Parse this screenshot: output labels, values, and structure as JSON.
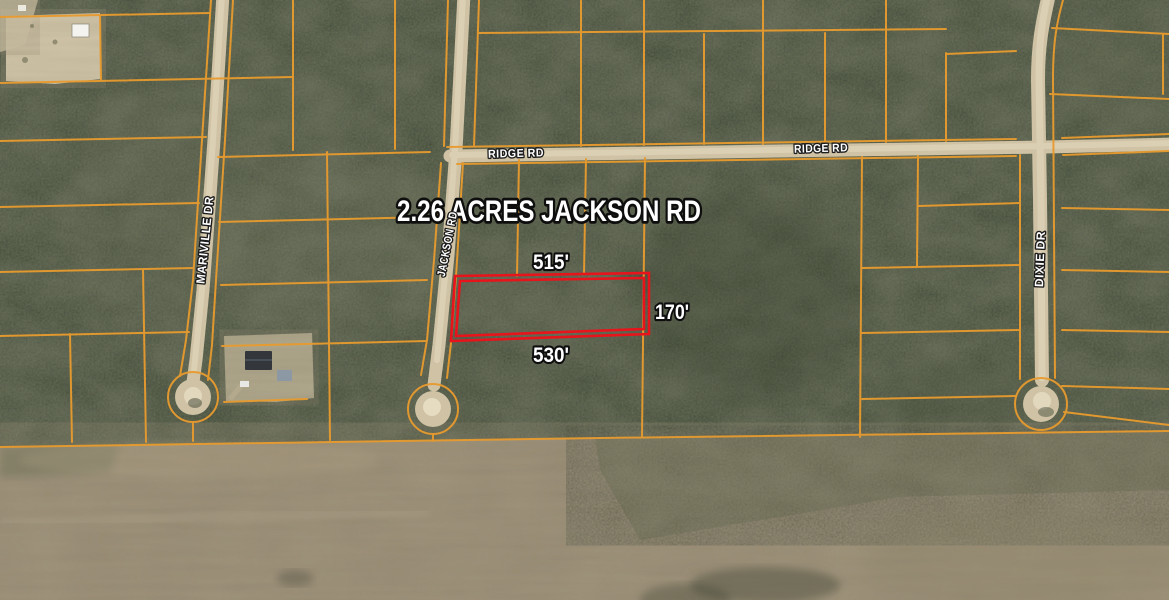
{
  "map": {
    "title": "2.26 ACRES JACKSON RD",
    "parcel": {
      "top_dimension": "515'",
      "right_dimension": "170'",
      "bottom_dimension": "530'"
    },
    "road_labels": {
      "ridge_rd_west": "RIDGE RD",
      "ridge_rd_east": "RIDGE RD",
      "jackson_rd": "JACKSON RD",
      "mariville_dr": "MARIVILLE DR",
      "dixie_dr": "DIXIE DR"
    },
    "colors": {
      "parcel_line": "#e89b2e",
      "highlight_outline": "#e8141c",
      "road_surface": "#cfc2a5",
      "forest_base": "#5d6850",
      "field_base": "#9a8e77"
    }
  }
}
